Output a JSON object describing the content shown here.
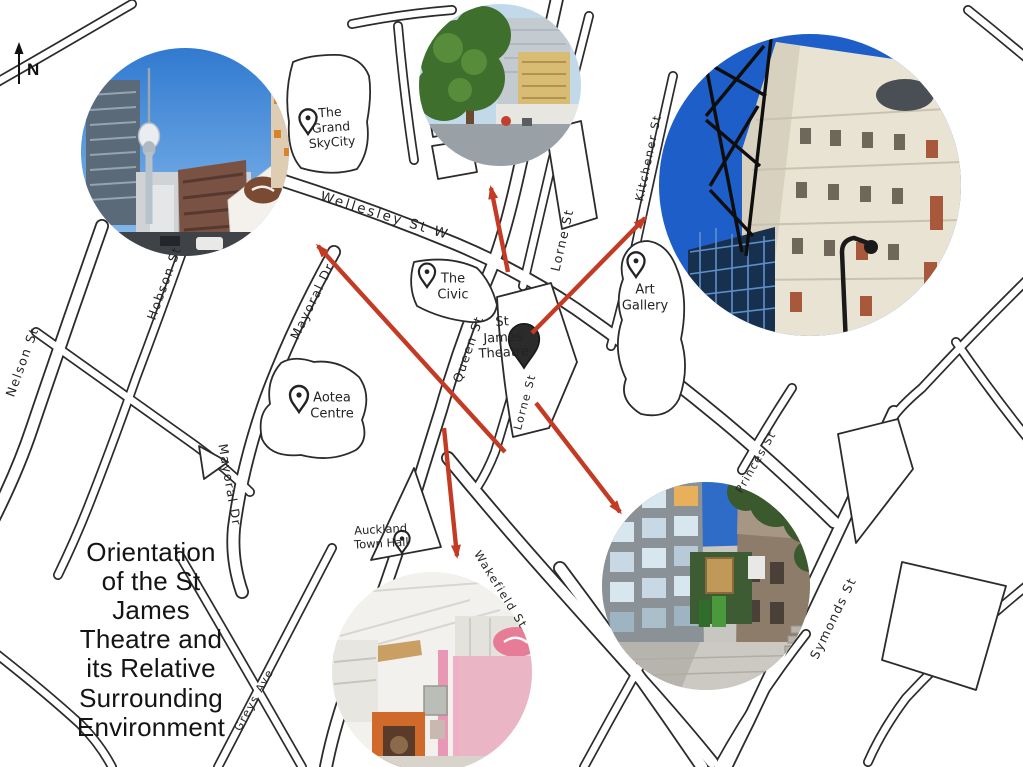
{
  "compass": {
    "label": "N"
  },
  "title": {
    "text": "Orientation of the St James Theatre and its Relative Surrounding Environment",
    "lines": [
      "Orientation",
      "of the St",
      "James",
      "Theatre and",
      "its Relative",
      "Surrounding",
      "Environment"
    ]
  },
  "map": {
    "street_labels": [
      {
        "id": "wellesley",
        "text": "Wellesley St W"
      },
      {
        "id": "hobson",
        "text": "Hobson St"
      },
      {
        "id": "nelson",
        "text": "Nelson St"
      },
      {
        "id": "mayoral-upper",
        "text": "Mayoral Dr"
      },
      {
        "id": "mayoral-lower",
        "text": "Mayoral Dr"
      },
      {
        "id": "greys",
        "text": "Greys Ave"
      },
      {
        "id": "queen",
        "text": "Queen St"
      },
      {
        "id": "lorne-upper",
        "text": "Lorne St"
      },
      {
        "id": "lorne-lower",
        "text": "Lorne St"
      },
      {
        "id": "kitchener",
        "text": "Kitchener St"
      },
      {
        "id": "wakefield",
        "text": "Wakefield St"
      },
      {
        "id": "princes",
        "text": "Princes St"
      },
      {
        "id": "symonds",
        "text": "Symonds St"
      }
    ],
    "landmarks": [
      {
        "id": "grand-skycity",
        "text": "The\nGrand\nSkyCity"
      },
      {
        "id": "the-civic",
        "text": "The\nCivic"
      },
      {
        "id": "st-james-theatre",
        "text": "St\nJames\nTheatre"
      },
      {
        "id": "art-gallery",
        "text": "Art\nGallery"
      },
      {
        "id": "aotea-centre",
        "text": "Aotea\nCentre"
      },
      {
        "id": "auckland-town-hall",
        "text": "Auckland\nTown Hall"
      }
    ]
  },
  "photos": [
    {
      "id": "sky-tower-street-view"
    },
    {
      "id": "queen-st-tree-view"
    },
    {
      "id": "st-james-building-view"
    },
    {
      "id": "laneway-interior-view"
    },
    {
      "id": "lorne-st-buildings-view"
    }
  ],
  "colors": {
    "arrow": "#c43b25",
    "ink": "#2b2b2b",
    "sky_blue": "#2e78cf"
  }
}
